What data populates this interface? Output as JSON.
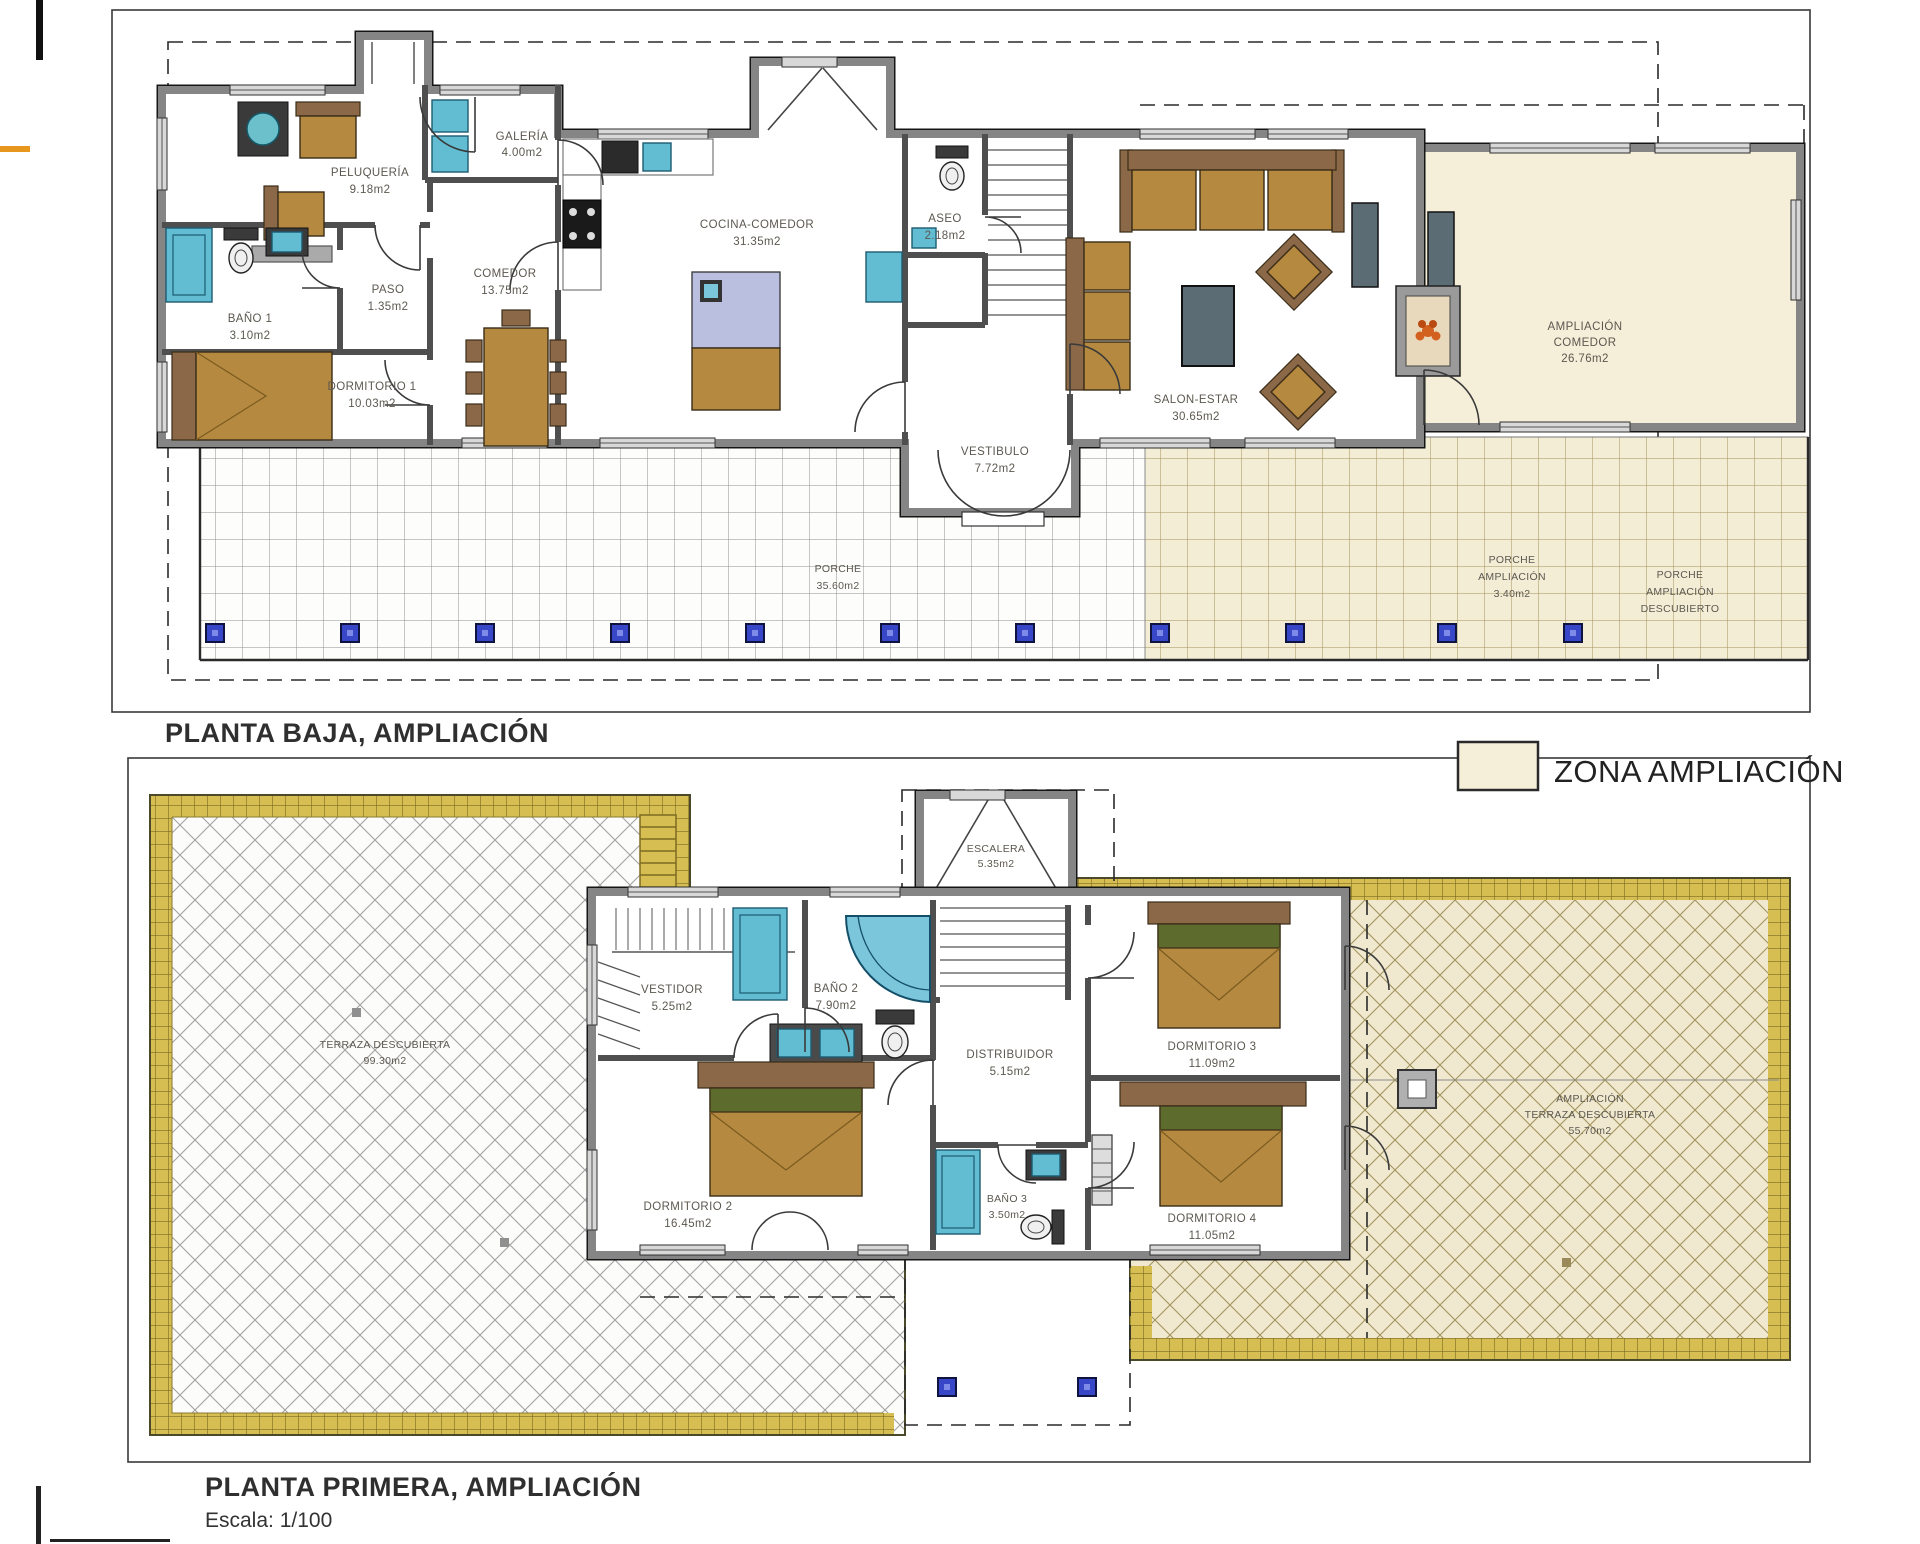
{
  "titles": {
    "ground": "PLANTA BAJA, AMPLIACIÓN",
    "first": "PLANTA PRIMERA, AMPLIACIÓN",
    "scale": "Escala: 1/100"
  },
  "legend": {
    "label": "ZONA AMPLIACIÓN",
    "swatch_color": "#f5eed8"
  },
  "colors": {
    "ampliacion_zone": "#f5eed8",
    "gold_border": "#d7be52",
    "pillar_blue": "#3847c8",
    "fixture_blue": "#62bcd2",
    "wood": "#b5893f",
    "wall_gray": "#858585"
  },
  "floors": {
    "ground": {
      "rooms": {
        "peluqueria": {
          "name": "PELUQUERÍA",
          "area": "9.18m2"
        },
        "galeria": {
          "name": "GALERÍA",
          "area": "4.00m2"
        },
        "comedor": {
          "name": "COMEDOR",
          "area": "13.75m2"
        },
        "paso": {
          "name": "PASO",
          "area": "1.35m2"
        },
        "bano1": {
          "name": "BAÑO 1",
          "area": "3.10m2"
        },
        "dormitorio1": {
          "name": "DORMITORIO 1",
          "area": "10.03m2"
        },
        "cocina_comedor": {
          "name": "COCINA-COMEDOR",
          "area": "31.35m2"
        },
        "aseo": {
          "name": "ASEO",
          "area": "2.18m2"
        },
        "vestibulo": {
          "name": "VESTIBULO",
          "area": "7.72m2"
        },
        "salon_estar": {
          "name": "SALON-ESTAR",
          "area": "30.65m2"
        },
        "ampliacion_comedor": {
          "line1": "AMPLIACIÓN",
          "line2": "COMEDOR",
          "area": "26.76m2"
        },
        "porche": {
          "name": "PORCHE",
          "area": "35.60m2"
        },
        "porche_ampliacion": {
          "line1": "PORCHE",
          "line2": "AMPLIACIÓN",
          "area": "3.40m2"
        },
        "porche_ampliacion_descubierto": {
          "line1": "PORCHE",
          "line2": "AMPLIACIÓN",
          "line3": "DESCUBIERTO"
        }
      }
    },
    "first": {
      "rooms": {
        "escalera": {
          "name": "ESCALERA",
          "area": "5.35m2"
        },
        "vestidor": {
          "name": "VESTIDOR",
          "area": "5.25m2"
        },
        "bano2": {
          "name": "BAÑO 2",
          "area": "7.90m2"
        },
        "distribuidor": {
          "name": "DISTRIBUIDOR",
          "area": "5.15m2"
        },
        "dormitorio2": {
          "name": "DORMITORIO 2",
          "area": "16.45m2"
        },
        "dormitorio3": {
          "name": "DORMITORIO 3",
          "area": "11.09m2"
        },
        "dormitorio4": {
          "name": "DORMITORIO 4",
          "area": "11.05m2"
        },
        "bano3": {
          "name": "BAÑO 3",
          "area": "3.50m2"
        },
        "terraza": {
          "name": "TERRAZA DESCUBIERTA",
          "area": "99.30m2"
        },
        "ampliacion_terraza": {
          "line1": "AMPLIACIÓN",
          "line2": "TERRAZA DESCUBIERTA",
          "area": "55.70m2"
        }
      }
    }
  }
}
